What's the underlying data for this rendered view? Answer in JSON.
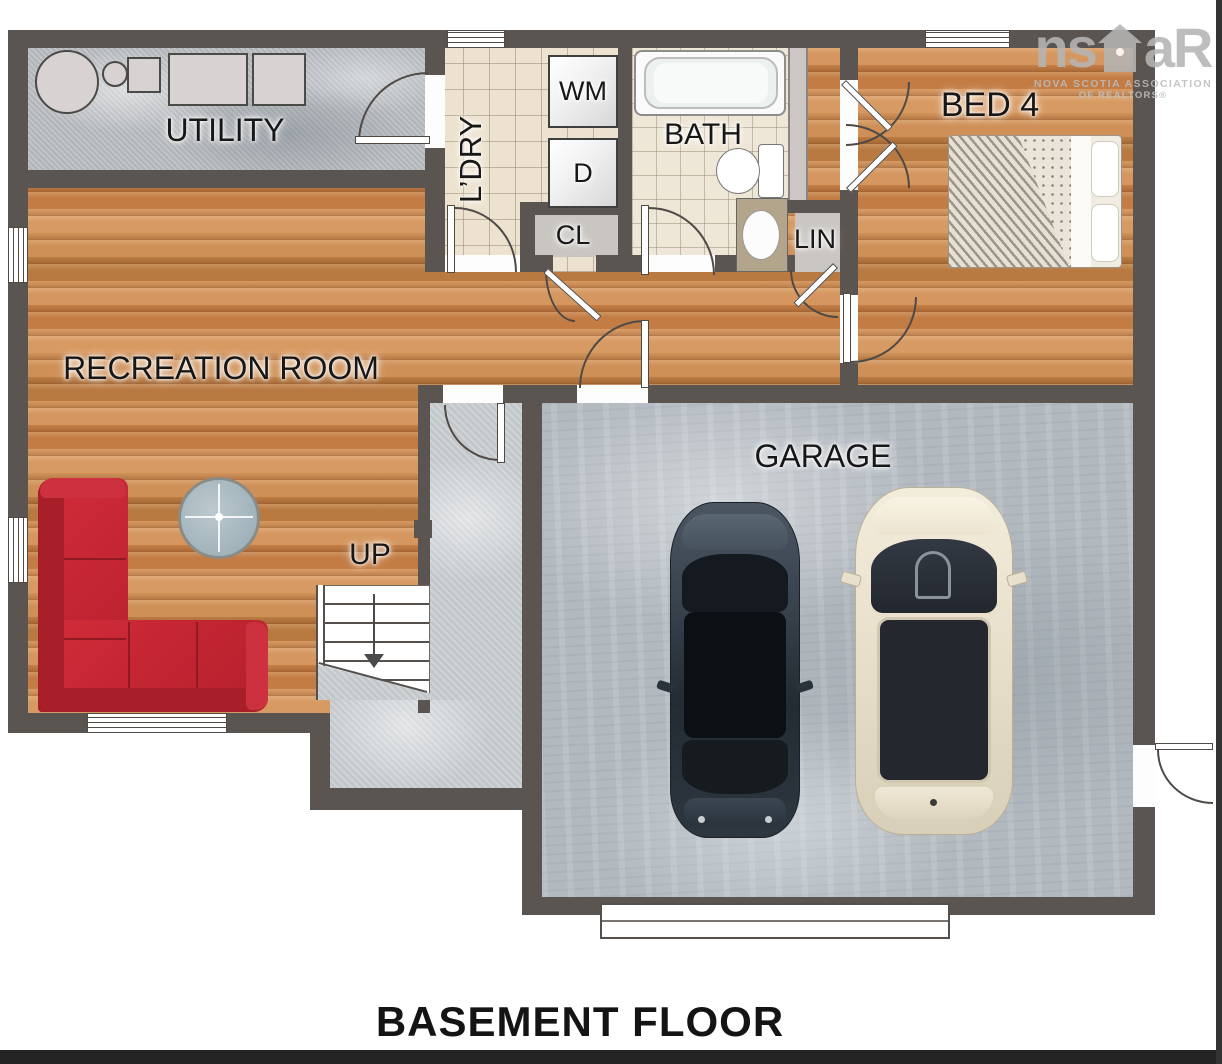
{
  "title": "BASEMENT FLOOR",
  "logo": {
    "part1": "ns",
    "part2": "aR",
    "line1": "NOVA SCOTIA ASSOCIATION",
    "line2": "OF REALTORS®"
  },
  "labels": {
    "utility": "UTILITY",
    "laundry": "L’DRY",
    "washer": "WM",
    "dryer": "D",
    "bath": "BATH",
    "closet": "CL",
    "linen": "LIN",
    "bed4": "BED 4",
    "recreation": "RECREATION ROOM",
    "up": "UP",
    "garage": "GARAGE"
  },
  "colors": {
    "wall": "#5b5551",
    "wood_floor": "#c9854e",
    "tile_floor": "#ece2cf",
    "concrete_floor": "#b7bbbf",
    "sofa": "#c22733",
    "label_text": "#171717",
    "logo_gray": "#b5b5b5"
  }
}
